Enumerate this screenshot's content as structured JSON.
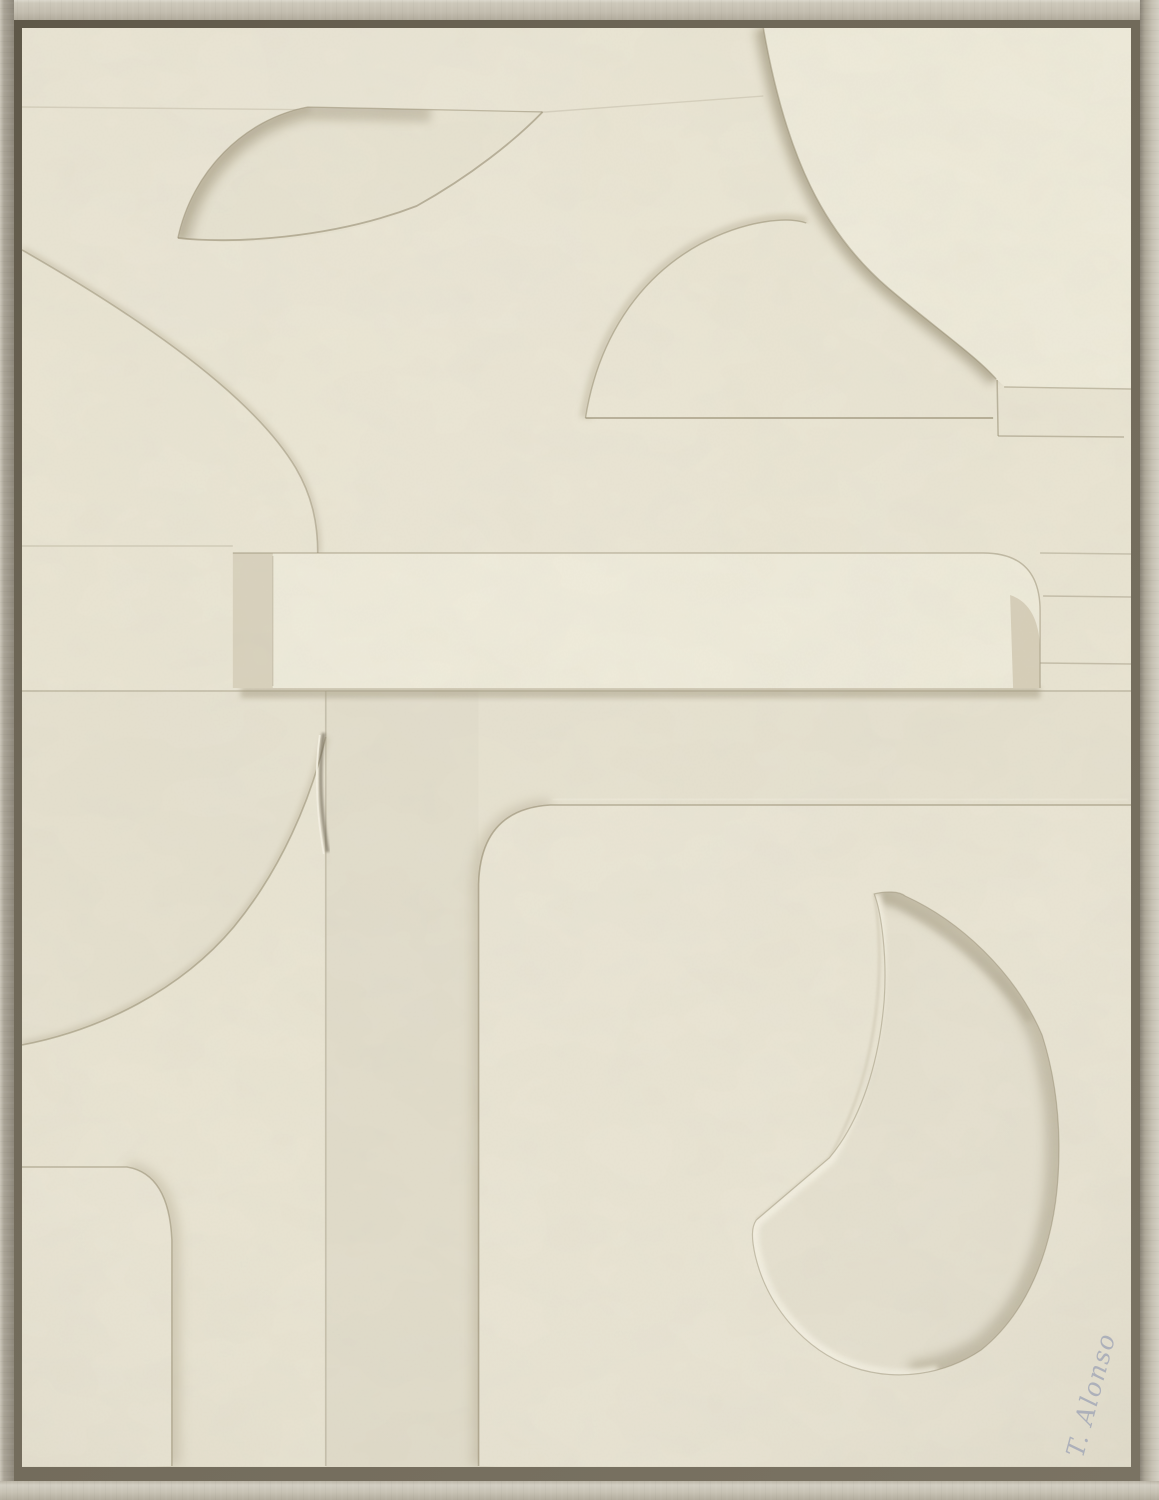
{
  "artwork": {
    "signature": "T. Alonso",
    "description": "Framed abstract plaster relief in cream tones with leaf, disc, bar and teardrop shapes"
  },
  "colors": {
    "canvas-base": "#e9e4d2",
    "canvas-light": "#eeead9",
    "shadow-strong": "#a1987e",
    "shadow-mid": "#bcb39a",
    "edge-line": "#8f8669",
    "highlight": "#f6f2e3",
    "frame-gap": "#6f6858",
    "frame-wood": "#c3bdb0",
    "signature": "#a6abb8",
    "bar-cap": "#d7d0bb",
    "bar-bevel": "#d4ccb6"
  }
}
